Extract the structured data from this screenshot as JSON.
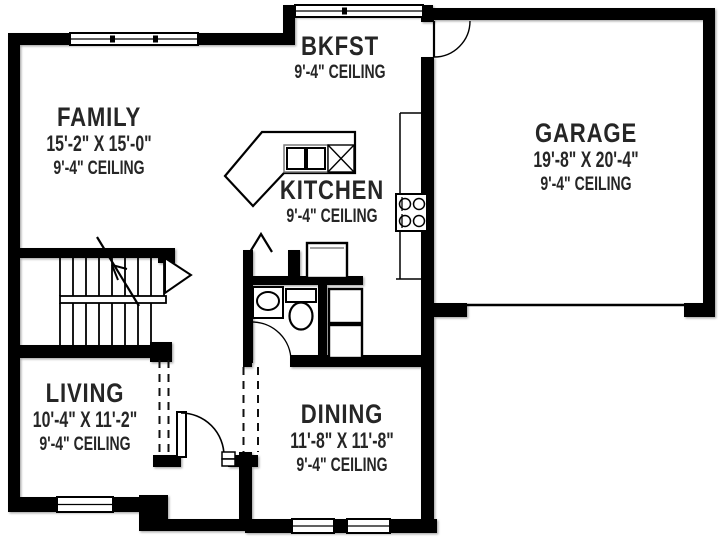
{
  "plan": {
    "background_color": "#ffffff",
    "wall_color": "#000000",
    "text_color": "#262626"
  },
  "rooms": {
    "family": {
      "name": "FAMILY",
      "dims": "15'-2\" X 15'-0\"",
      "ceiling": "9'-4\" CEILING"
    },
    "bkfst": {
      "name": "BKFST",
      "ceiling": "9'-4\" CEILING"
    },
    "kitchen": {
      "name": "KITCHEN",
      "ceiling": "9'-4\" CEILING"
    },
    "garage": {
      "name": "GARAGE",
      "dims": "19'-8\" X 20'-4\"",
      "ceiling": "9'-4\" CEILING"
    },
    "living": {
      "name": "LIVING",
      "dims": "10'-4\" X 11'-2\"",
      "ceiling": "9'-4\" CEILING"
    },
    "dining": {
      "name": "DINING",
      "dims": "11'-8\" X 11'-8\"",
      "ceiling": "9'-4\" CEILING"
    }
  },
  "fixtures": [
    "staircase",
    "kitchen-island",
    "double-sink",
    "dishwasher",
    "range-cooktop",
    "refrigerator",
    "pantry-bifold-door",
    "powder-room-sink",
    "toilet",
    "washer-dryer-stack",
    "front-door",
    "interior-doors",
    "garage-door-opening",
    "windows"
  ]
}
